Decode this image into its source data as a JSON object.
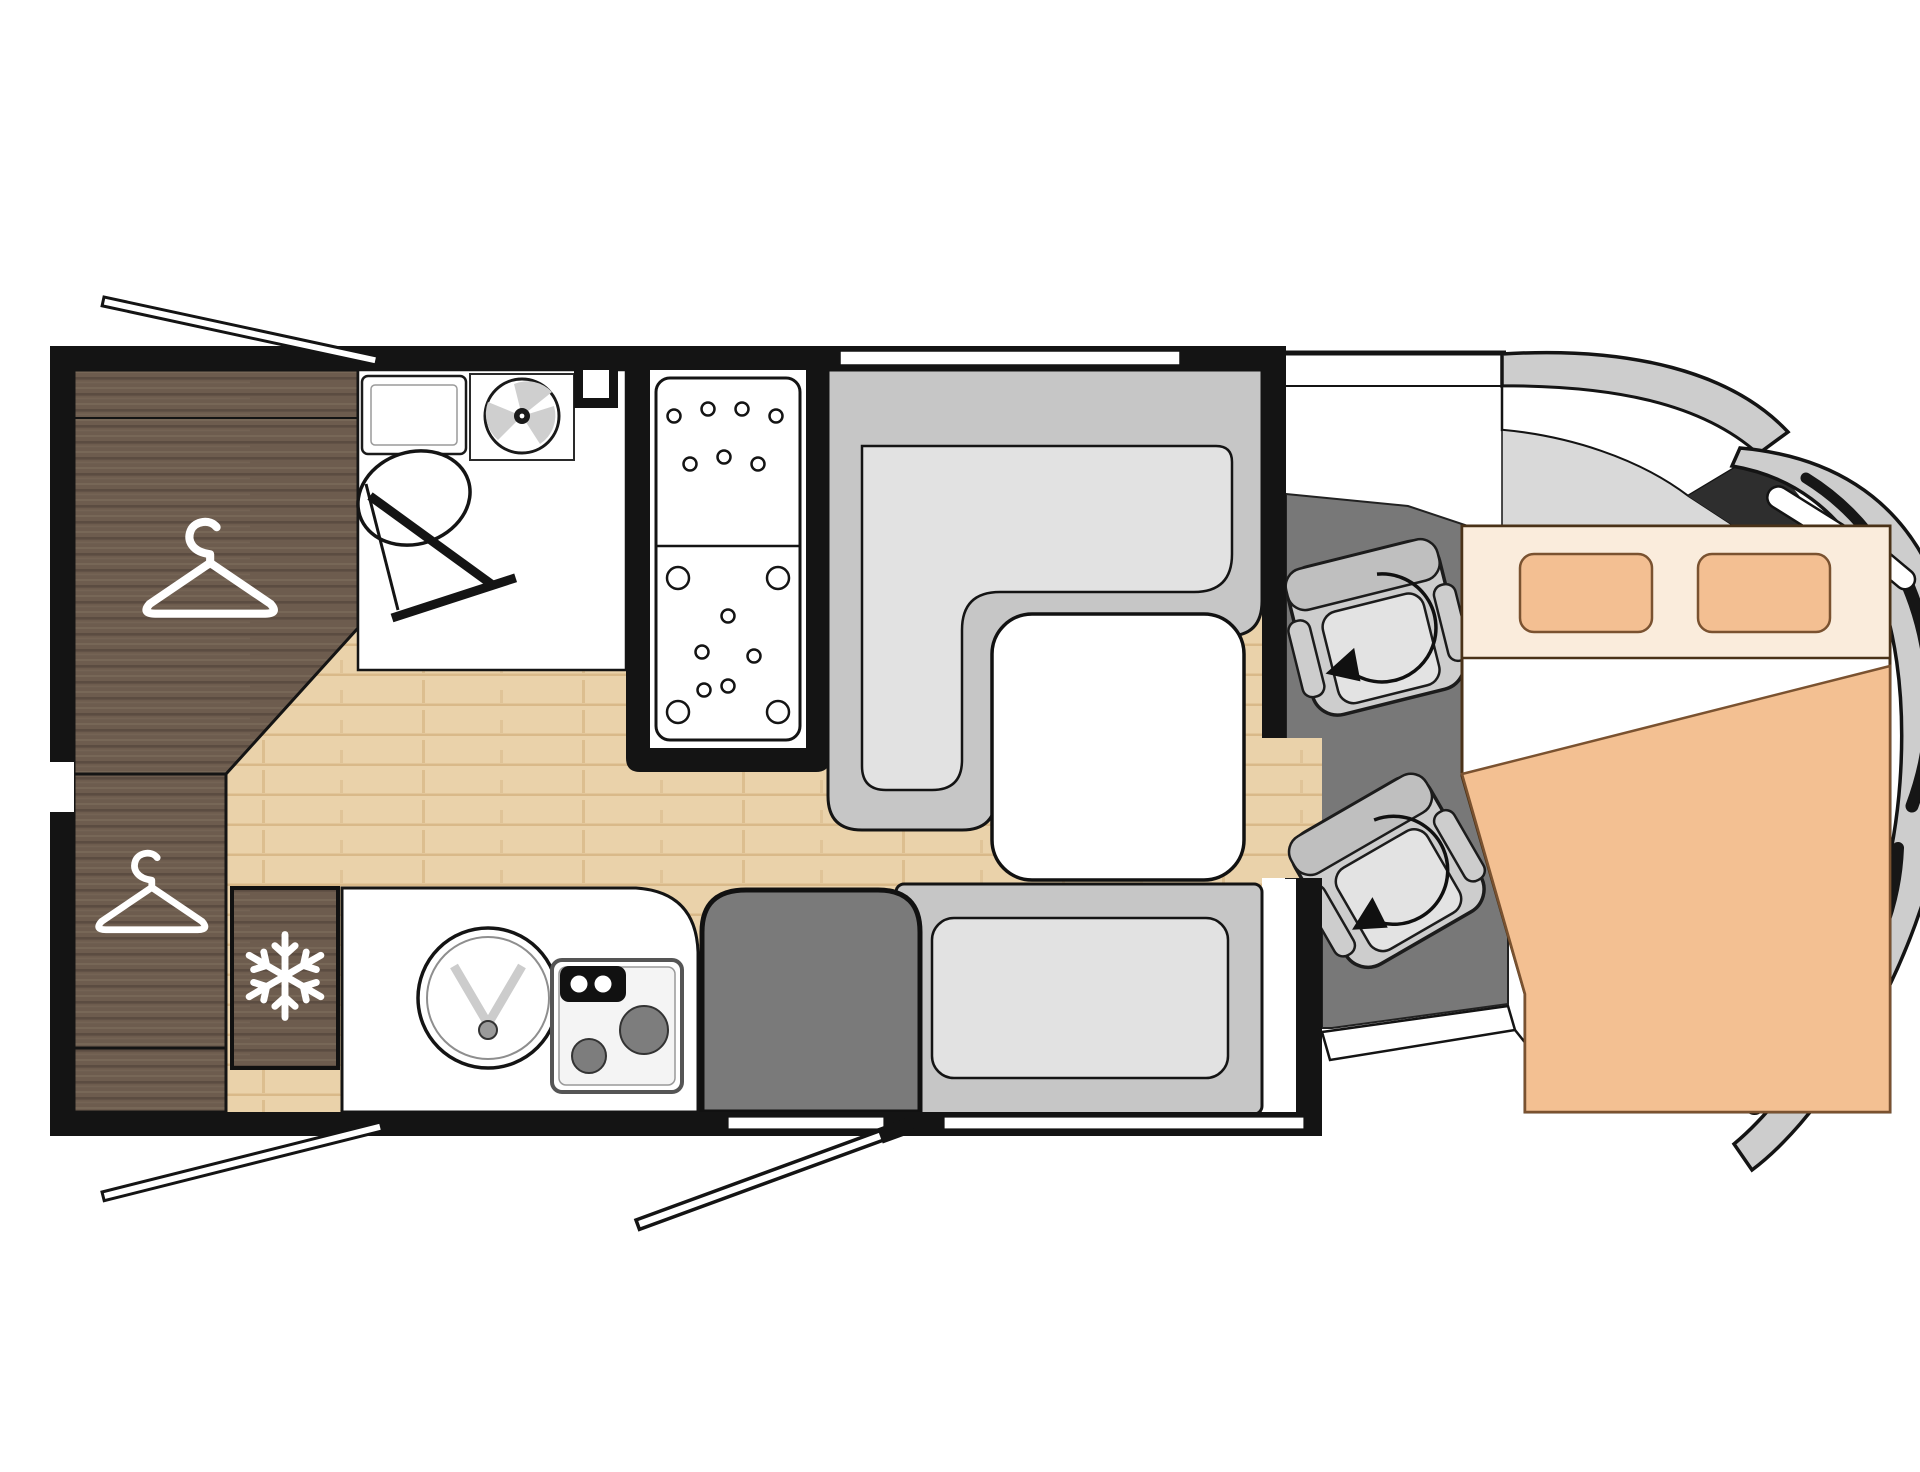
{
  "diagram": {
    "type": "floor-plan",
    "subject": "motorhome-interior-top-down-layout",
    "areas": [
      {
        "name": "rear-wardrobe",
        "icon": "hanger-icon",
        "hanger_count": 2
      },
      {
        "name": "bathroom",
        "features": [
          "toilet",
          "corner-washbasin",
          "roof-fan",
          "open-door"
        ]
      },
      {
        "name": "shower-cabin",
        "features": [
          "shower-tray-with-drain-dots"
        ]
      },
      {
        "name": "fridge-freezer",
        "icon": "snowflake-icon"
      },
      {
        "name": "kitchen",
        "features": [
          "round-sink",
          "two-burner-hob",
          "control-panel"
        ]
      },
      {
        "name": "dinette",
        "features": [
          "l-shaped-bench",
          "white-table"
        ]
      },
      {
        "name": "side-bench",
        "features": [
          "cushion"
        ]
      },
      {
        "name": "entrance",
        "features": [
          "entry-step",
          "open-entry-door"
        ]
      },
      {
        "name": "cab",
        "icon": "swivel-arrow-icon",
        "features": [
          "driver-swivel-seat",
          "passenger-swivel-seat"
        ]
      },
      {
        "name": "front-drop-down-bed",
        "features": [
          "double-mattress",
          "two-pillows",
          "blanket",
          "folded-sheet"
        ]
      },
      {
        "name": "vehicle-front",
        "features": [
          "windshield",
          "a-pillar",
          "side-mirror-slashes",
          "front-fender-arc"
        ]
      }
    ],
    "openings": [
      {
        "name": "rear-top-window",
        "state": "open-flap"
      },
      {
        "name": "rear-bottom-window",
        "state": "open-flap"
      },
      {
        "name": "entry-door",
        "state": "open-flap"
      },
      {
        "name": "dinette-window",
        "state": "closed-strip"
      },
      {
        "name": "bench-side-window",
        "state": "closed-strip"
      },
      {
        "name": "left-wall-vent",
        "state": "gap"
      }
    ],
    "colors": {
      "wall": "#141414",
      "floor": "#ead2aa",
      "floorLine": "#d6b584",
      "wood": "#6d5c4e",
      "woodLight": "#80705f",
      "woodDark": "#51443a",
      "white": "#ffffff",
      "benchBase": "#c6c6c6",
      "cushion": "#e2e2e2",
      "cabFloor": "#787878",
      "stepGray": "#7a7a7a",
      "seatBody": "#cdcdcd",
      "seatBand": "#bfbfbf",
      "seatCushion": "#e3e3e3",
      "bodyGray": "#cdcdcd",
      "windshieldDark": "#2e2e2e",
      "burner": "#7d7d7d",
      "bedHeadboard": "#faecdc",
      "blanket": "#f3c092",
      "pillow": "#f3bf92",
      "bedOutline": "#4a3218",
      "pillowStroke": "#7a5230"
    }
  }
}
